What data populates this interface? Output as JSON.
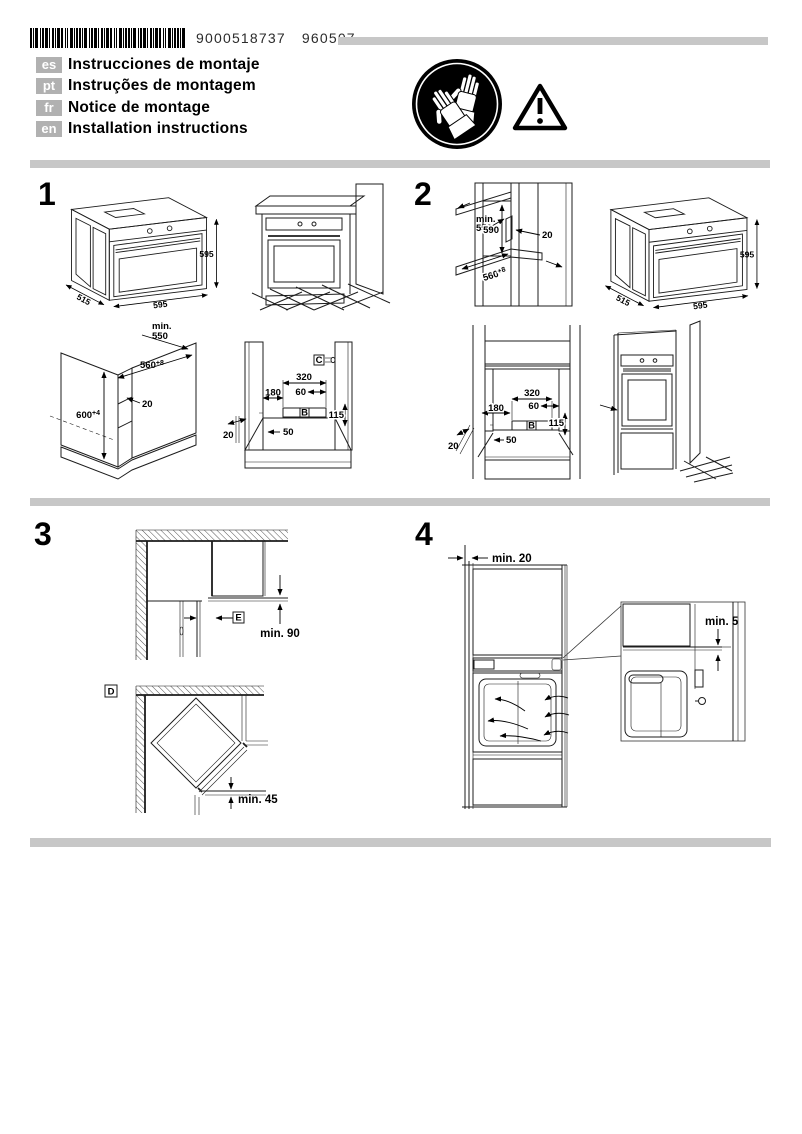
{
  "header": {
    "barcode_number": "9000518737",
    "production_code": "960507",
    "languages": [
      {
        "code": "es",
        "title": "Instrucciones de montaje"
      },
      {
        "code": "pt",
        "title": "Instruções de montagem"
      },
      {
        "code": "fr",
        "title": "Notice de montage"
      },
      {
        "code": "en",
        "title": "Installation instructions"
      }
    ],
    "icons": {
      "gloves": "wear-protective-gloves-icon",
      "warning": "warning-triangle-icon"
    }
  },
  "section1": {
    "number": "1",
    "oven": {
      "height": "595",
      "depth": "515",
      "width": "595"
    },
    "cabinet": {
      "min_label": "min.",
      "min_depth": "550",
      "niche_width_main": "560",
      "niche_width_sup": "+8",
      "niche_height_main": "600",
      "niche_height_sup": "+4",
      "rear_gap": "20"
    },
    "front": {
      "label_c": "C",
      "w320": "320",
      "w60": "60",
      "w180": "180",
      "label_b": "B",
      "h115": "115",
      "w50": "50",
      "g20": "20"
    }
  },
  "section2": {
    "number": "2",
    "niche": {
      "min_label": "min.",
      "min_depth": "550",
      "height": "590",
      "rear_gap": "20",
      "width_main": "560",
      "width_sup": "+8"
    },
    "oven": {
      "height": "595",
      "depth": "515",
      "width": "595"
    },
    "front": {
      "w320": "320",
      "w60": "60",
      "w180": "180",
      "label_b": "B",
      "h115": "115",
      "w50": "50",
      "g20": "20"
    }
  },
  "section3": {
    "number": "3",
    "label_e": "E",
    "min90": "min. 90",
    "label_d": "D",
    "min45": "min. 45"
  },
  "section4": {
    "number": "4",
    "min20": "min. 20",
    "min5": "min. 5"
  },
  "colors": {
    "divider": "#c7c7c7",
    "badge_bg": "#b1b1b1",
    "panel_gray": "#d9d9d9",
    "door_glass": "#d2d2d2",
    "dark_band": "#a6a6a6"
  }
}
